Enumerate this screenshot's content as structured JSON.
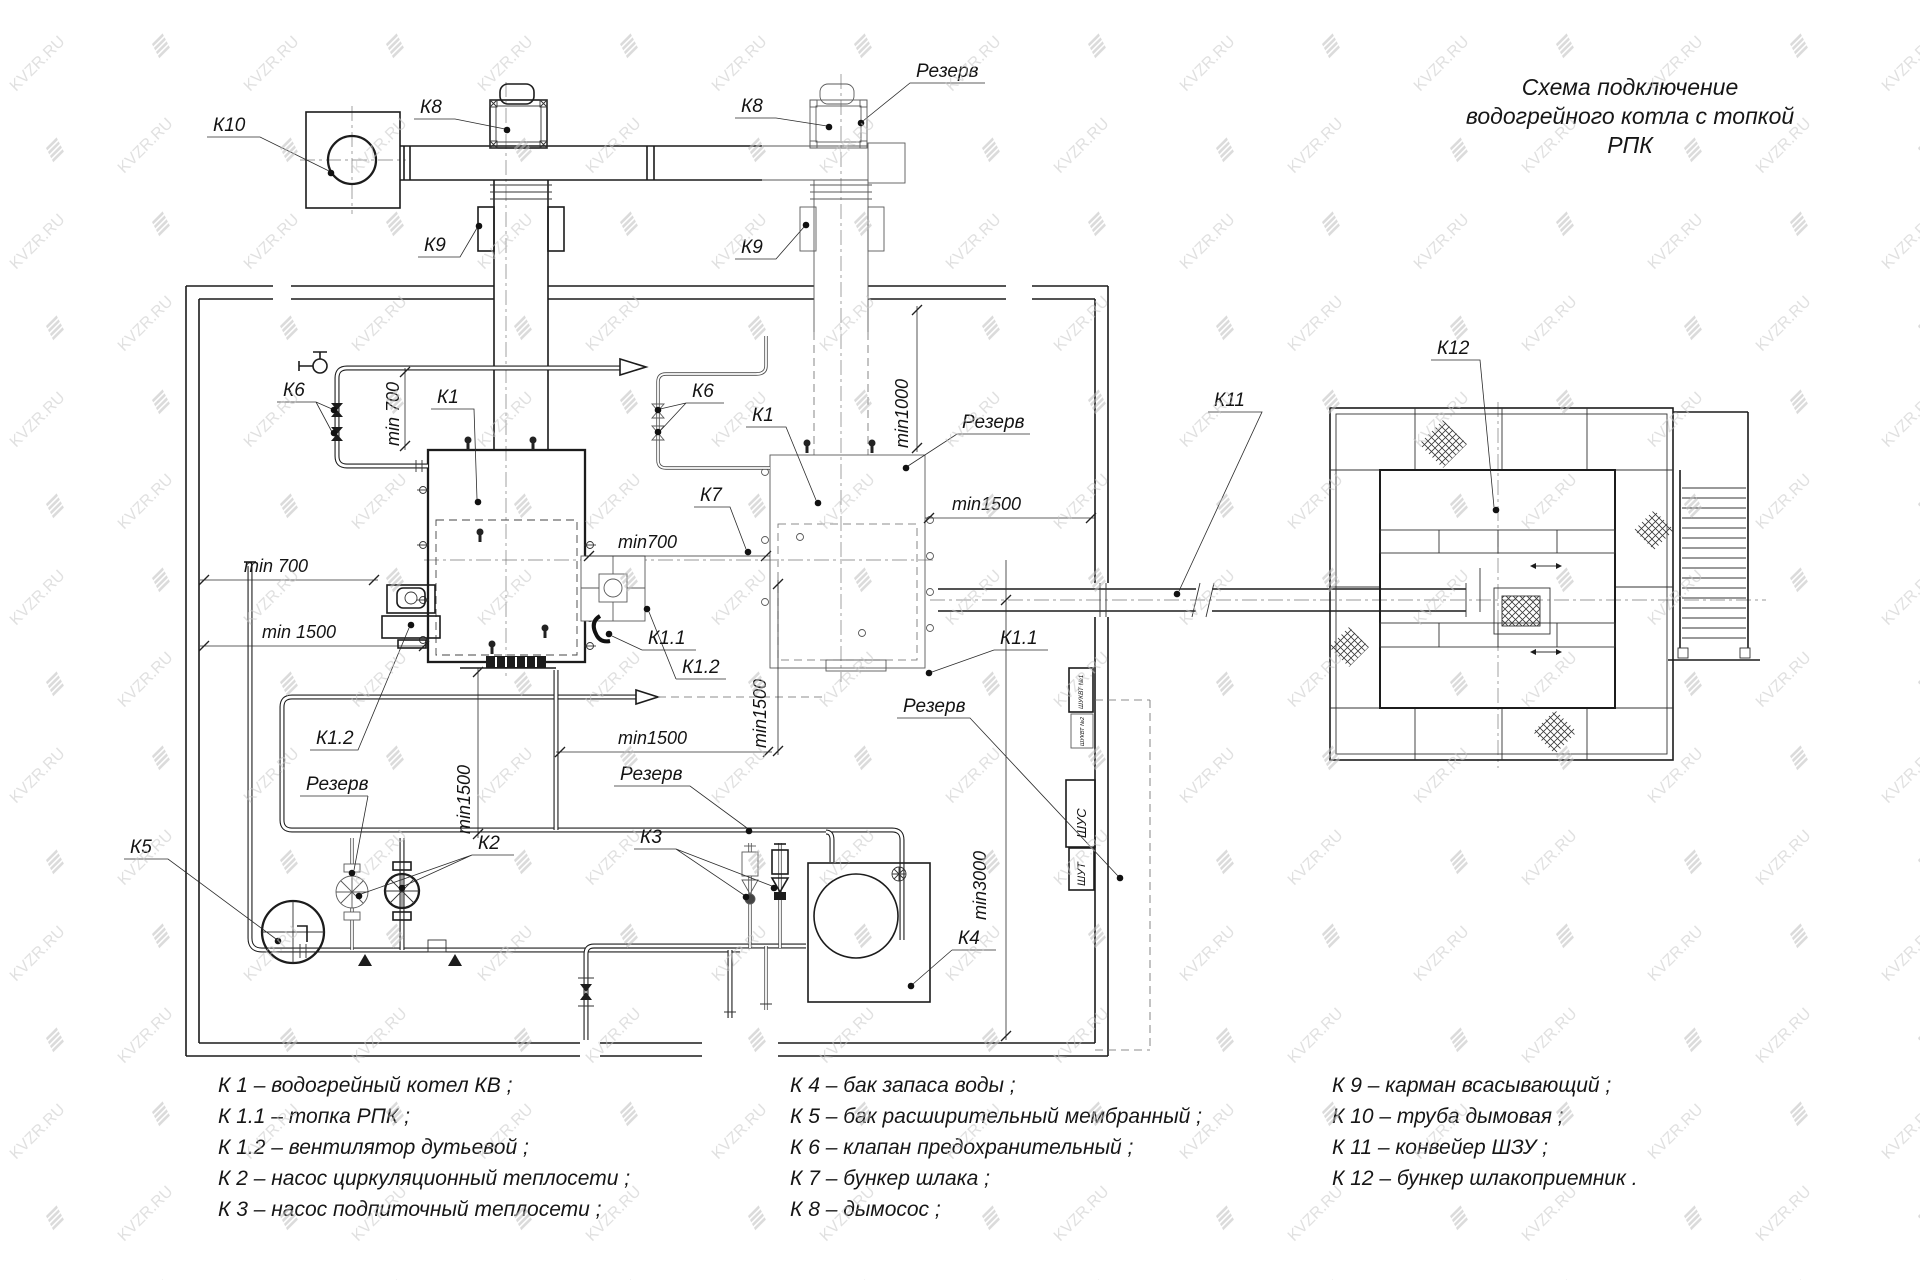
{
  "watermark": {
    "text": "KVZR.RU"
  },
  "title": {
    "line1": "Схема подключение",
    "line2": "водогрейного котла с топкой",
    "line3": "РПК"
  },
  "labels": {
    "k1": "К1",
    "k1_1": "К1.1",
    "k1_2": "К1.2",
    "k2": "К2",
    "k3": "К3",
    "k4": "К4",
    "k5": "К5",
    "k6": "К6",
    "k7": "К7",
    "k8": "К8",
    "k9": "К9",
    "k10": "К10",
    "k11": "К11",
    "k12": "К12",
    "reserve": "Резерв"
  },
  "dimensions": {
    "min700_sp": "min 700",
    "min1500_sp": "min 1500",
    "min700": "min700",
    "min1000": "min1000",
    "min1500": "min1500",
    "min3000": "min3000"
  },
  "cabinets": {
    "shukvt1": "ШУКВТ №1",
    "shukvt2": "ШУКВТ №2",
    "shus": "ШУС",
    "shut": "ШУТ"
  },
  "legend": {
    "col1": [
      "К 1 – водогрейный котел КВ ;",
      "К 1.1 – топка РПК ;",
      "К 1.2 – вентилятор дутьевой ;",
      "К 2 – насос циркуляционный теплосети ;",
      "К 3 – насос подпиточный теплосети ;"
    ],
    "col2": [
      "К 4 – бак запаса воды ;",
      "К 5 – бак расширительный мембранный ;",
      "К 6 – клапан предохранительный ;",
      "К 7 – бункер шлака ;",
      "К 8 – дымосос ;"
    ],
    "col3": [
      "К 9 – карман всасывающий ;",
      "К 10 – труба дымовая ;",
      "К 11 – конвейер ШЗУ ;",
      "К 12 – бункер шлакоприемник ."
    ]
  }
}
